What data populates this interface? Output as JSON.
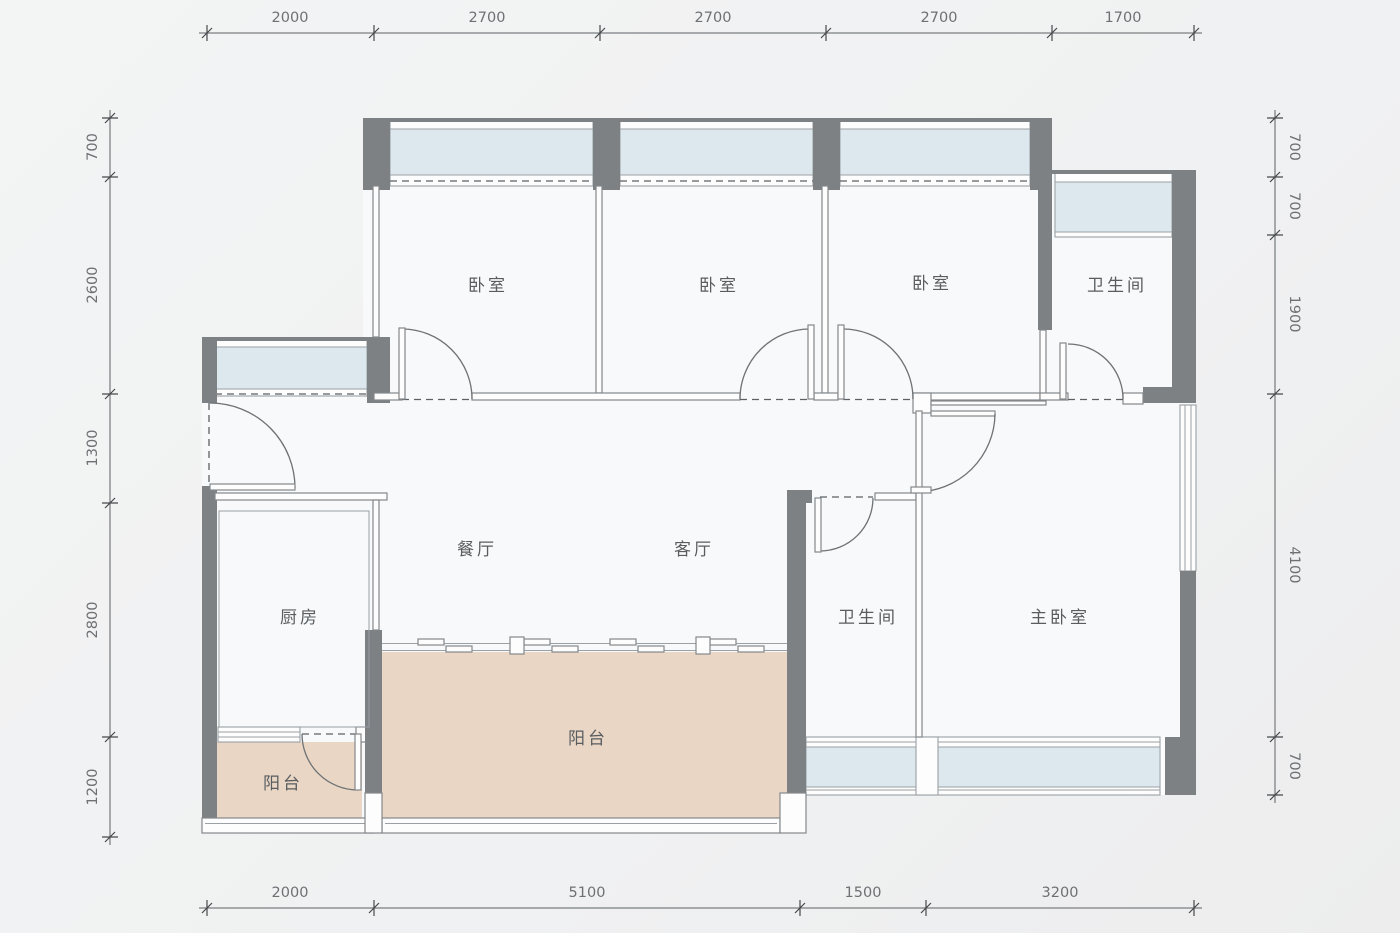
{
  "plan": {
    "rooms": {
      "bedroom1": "卧室",
      "bedroom2": "卧室",
      "bedroom3": "卧室",
      "bath_top": "卫生间",
      "bath_master": "卫生间",
      "kitchen": "厨房",
      "dining": "餐厅",
      "living": "客厅",
      "master_bedroom": "主卧室",
      "balcony_small": "阳台",
      "balcony_large": "阳台"
    },
    "dims": {
      "top": [
        "2000",
        "2700",
        "2700",
        "2700",
        "1700"
      ],
      "bottom": [
        "2000",
        "5100",
        "1500",
        "3200"
      ],
      "left": [
        "700",
        "2600",
        "1300",
        "2800",
        "1200"
      ],
      "right": [
        "700",
        "700",
        "1900",
        "4100",
        "700"
      ]
    },
    "colors": {
      "wall": "#7d8184",
      "window_glass": "#dce8ee",
      "balcony_floor": "#e9d6c4",
      "background": "#f1f2f2",
      "room_fill": "#f8f9fa",
      "dim_text": "#6e7174",
      "label_text": "#595d60"
    }
  }
}
